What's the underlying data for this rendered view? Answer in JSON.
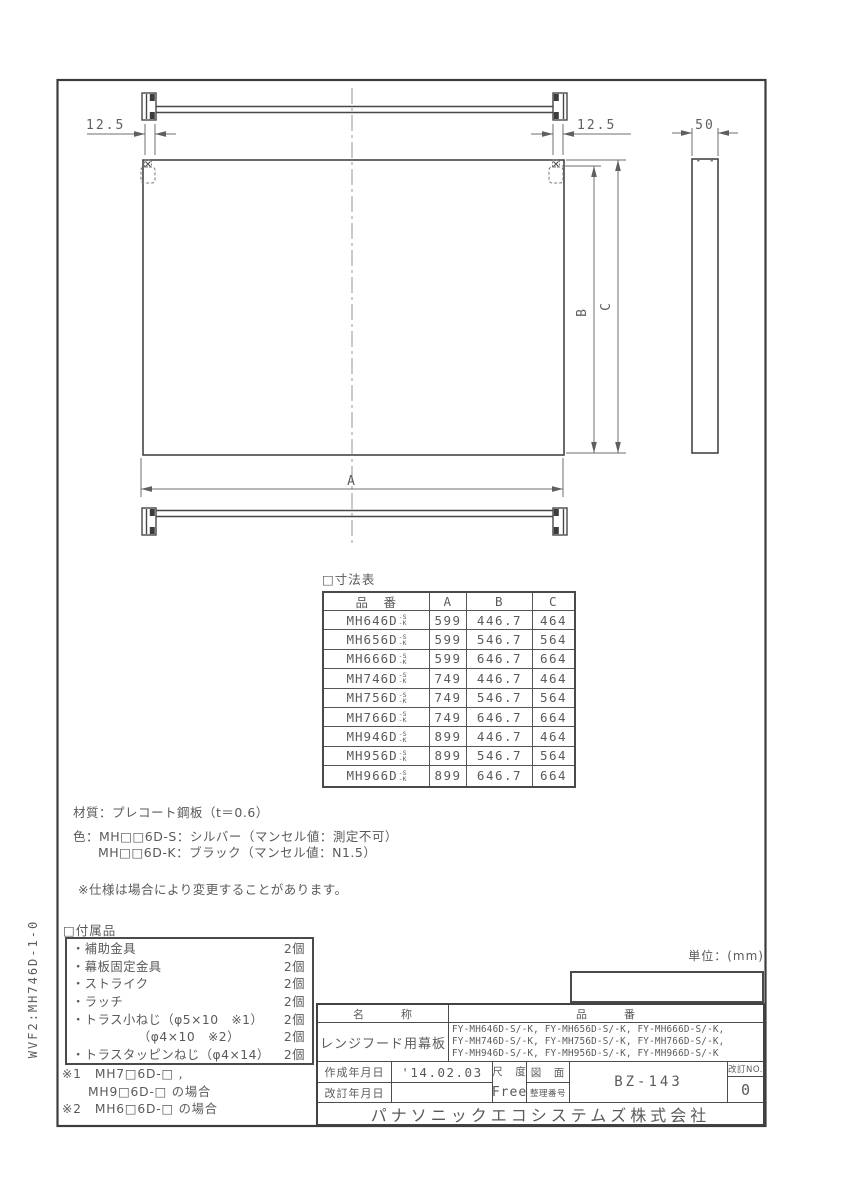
{
  "page": {
    "side_code": "WVF2:MH746D-1-0",
    "unit_note": "単位：(mm)"
  },
  "colors": {
    "outline_ink": "#3c3c3c",
    "dimension_ink": "#6f6f6f",
    "text_ink": "#5a5a5a"
  },
  "drawing": {
    "dim_offset_left": "12.5",
    "dim_offset_right": "12.5",
    "dim_depth": "50",
    "dim_width_label": "A",
    "dim_height_b_label": "B",
    "dim_height_c_label": "C"
  },
  "dim_table": {
    "title": "□寸法表",
    "col_model": "品　番",
    "col_a": "A",
    "col_b": "B",
    "col_c": "C",
    "variant_top": "-S",
    "variant_bottom": "-K",
    "rows": [
      {
        "model": "MH646D",
        "a": "599",
        "b": "446.7",
        "c": "464"
      },
      {
        "model": "MH656D",
        "a": "599",
        "b": "546.7",
        "c": "564"
      },
      {
        "model": "MH666D",
        "a": "599",
        "b": "646.7",
        "c": "664"
      },
      {
        "model": "MH746D",
        "a": "749",
        "b": "446.7",
        "c": "464"
      },
      {
        "model": "MH756D",
        "a": "749",
        "b": "546.7",
        "c": "564"
      },
      {
        "model": "MH766D",
        "a": "749",
        "b": "646.7",
        "c": "664"
      },
      {
        "model": "MH946D",
        "a": "899",
        "b": "446.7",
        "c": "464"
      },
      {
        "model": "MH956D",
        "a": "899",
        "b": "546.7",
        "c": "564"
      },
      {
        "model": "MH966D",
        "a": "899",
        "b": "646.7",
        "c": "664"
      }
    ]
  },
  "notes": {
    "material": "材質：プレコート鋼板（t＝0.6）",
    "color_line1": "色：MH□□6D-S：シルバー（マンセル値：測定不可）",
    "color_line2": "MH□□6D-K：ブラック（マンセル値：N1.5）",
    "disclaimer": "※仕様は場合により変更することがあります。"
  },
  "accessories": {
    "title": "□付属品",
    "items": [
      {
        "label": "・補助金具",
        "qty": "2個"
      },
      {
        "label": "・幕板固定金具",
        "qty": "2個"
      },
      {
        "label": "・ストライク",
        "qty": "2個"
      },
      {
        "label": "・ラッチ",
        "qty": "2個"
      },
      {
        "label": "・トラス小ねじ（φ5×10　※1）",
        "qty": "2個"
      },
      {
        "label": "（φ4×10　※2）",
        "qty": "2個",
        "indent": true
      },
      {
        "label": "・トラスタッピンねじ（φ4×14）",
        "qty": "2個"
      }
    ],
    "note1_line1": "※1　MH7□6D-□ ,",
    "note1_line2": "MH9□6D-□ の場合",
    "note2": "※2　MH6□6D-□ の場合"
  },
  "title_block": {
    "name_label": "名　　　称",
    "pn_label": "品　　　番",
    "name_value": "レンジフード用幕板",
    "pn_lines": [
      "FY-MH646D-S/-K, FY-MH656D-S/-K, FY-MH666D-S/-K,",
      "FY-MH746D-S/-K, FY-MH756D-S/-K, FY-MH766D-S/-K,",
      "FY-MH946D-S/-K, FY-MH956D-S/-K, FY-MH966D-S/-K"
    ],
    "created_label": "作成年月日",
    "created_value": "'14.02.03",
    "revised_label": "改訂年月日",
    "revised_value": "",
    "scale_label": "尺　度",
    "scale_value": "Free",
    "drawing_label": "図　面",
    "refno_label": "整理番号",
    "drawing_number": "BZ-143",
    "revno_label": "改訂NO.",
    "revno_value": "0",
    "company": "パナソニックエコシステムズ株式会社"
  }
}
